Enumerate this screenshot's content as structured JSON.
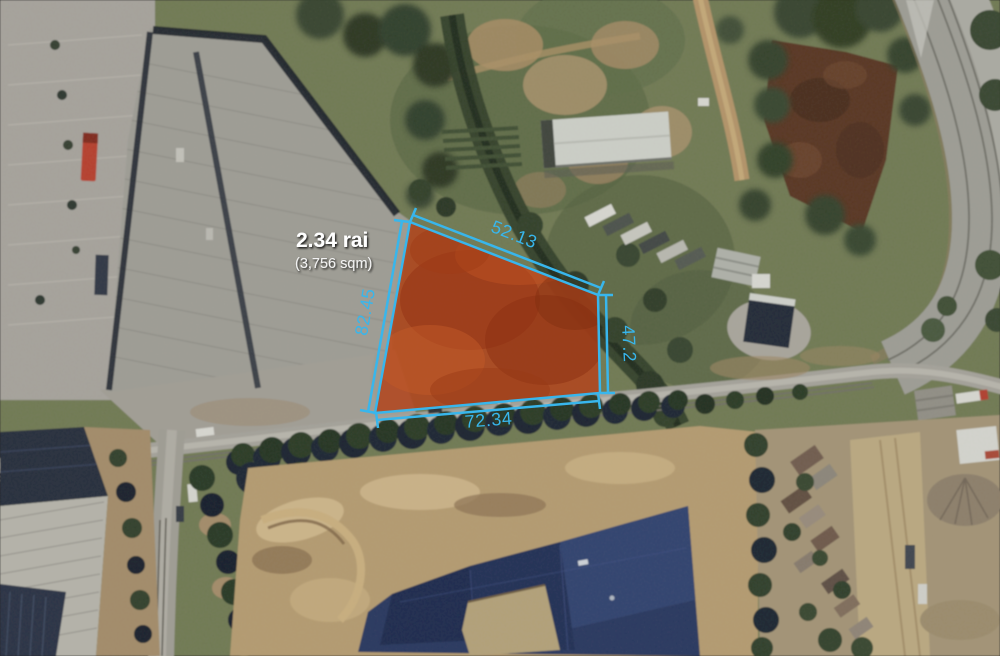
{
  "map_annotation": {
    "area_label": "2.34 rai",
    "area_sublabel": "(3,756 sqm)",
    "dimensions": {
      "top": "52.13",
      "left": "82.45",
      "right": "47.2",
      "bottom": "72.34"
    },
    "accent_color": "#38b6ec",
    "plot_fill_color": "#b0471f"
  }
}
